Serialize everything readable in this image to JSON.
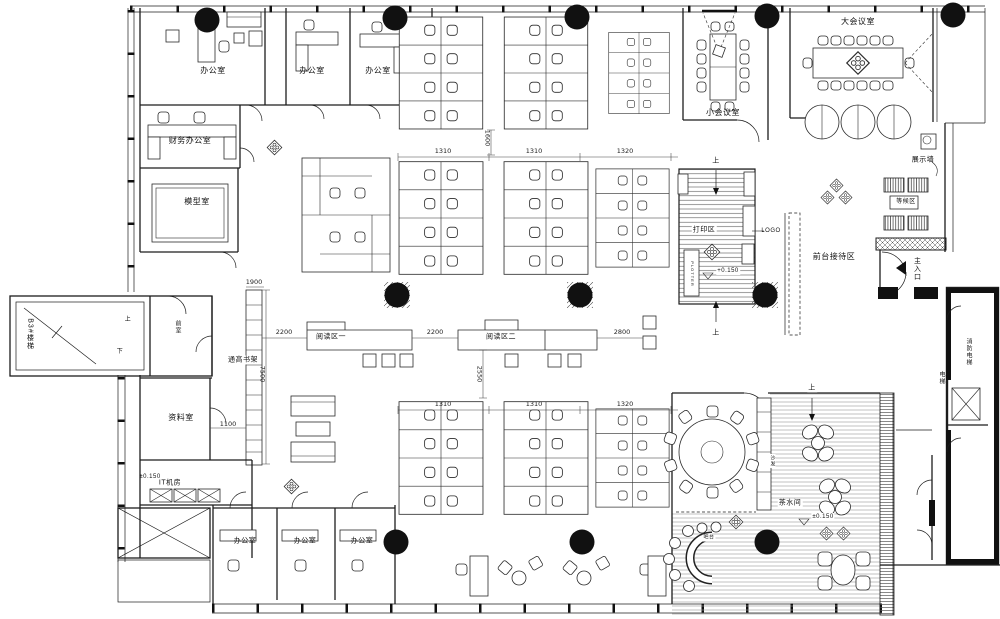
{
  "canvas": {
    "width": 1000,
    "height": 619,
    "background": "#ffffff",
    "ink": "#1c1c1c",
    "column_fill": "#111111"
  },
  "icons": {
    "column": "filled-circle",
    "entrance_arrow": "left-filled-triangle",
    "level_marker": "open-triangle-down",
    "elevator": "crossed-box",
    "decor": "diamond-rosette"
  },
  "texts": [
    {
      "name": "label-office-1",
      "text": "办公室",
      "x": 213,
      "y": 71,
      "fs": 8
    },
    {
      "name": "label-office-2",
      "text": "办公室",
      "x": 312,
      "y": 71,
      "fs": 8
    },
    {
      "name": "label-office-3",
      "text": "办公室",
      "x": 378,
      "y": 71,
      "fs": 8
    },
    {
      "name": "label-finance-office",
      "text": "财务办公室",
      "x": 190,
      "y": 141,
      "fs": 8
    },
    {
      "name": "label-model-room",
      "text": "模型室",
      "x": 197,
      "y": 202,
      "fs": 8
    },
    {
      "name": "label-small-meeting-room",
      "text": "小会议室",
      "x": 723,
      "y": 113,
      "fs": 8
    },
    {
      "name": "label-large-meeting-room",
      "text": "大会议室",
      "x": 858,
      "y": 22,
      "fs": 8
    },
    {
      "name": "label-display-wall",
      "text": "展示墙",
      "x": 923,
      "y": 160,
      "fs": 7
    },
    {
      "name": "label-waiting-area",
      "text": "等候区",
      "x": 906,
      "y": 202,
      "fs": 6,
      "bg": true
    },
    {
      "name": "label-print-area",
      "text": "打印区",
      "x": 704,
      "y": 230,
      "fs": 7,
      "bg": true
    },
    {
      "name": "label-logo",
      "text": "LOGO",
      "x": 771,
      "y": 231,
      "fs": 6
    },
    {
      "name": "label-reception-area",
      "text": "前台接待区",
      "x": 834,
      "y": 257,
      "fs": 8
    },
    {
      "name": "label-reading-area-1",
      "text": "阅读区一",
      "x": 331,
      "y": 337,
      "fs": 7
    },
    {
      "name": "label-reading-area-2",
      "text": "阅读区二",
      "x": 501,
      "y": 337,
      "fs": 7
    },
    {
      "name": "label-tall-bookshelf",
      "text": "通高书架",
      "x": 243,
      "y": 360,
      "fs": 7,
      "bg": true
    },
    {
      "name": "label-b3-stair",
      "text": "B3#楼梯",
      "x": 30,
      "y": 334,
      "fs": 7,
      "v": true
    },
    {
      "name": "label-stair-up",
      "text": "上",
      "x": 128,
      "y": 320,
      "fs": 6
    },
    {
      "name": "label-stair-down",
      "text": "下",
      "x": 120,
      "y": 352,
      "fs": 6
    },
    {
      "name": "label-vestibule",
      "text": "前室",
      "x": 177,
      "y": 327,
      "fs": 6,
      "v": true
    },
    {
      "name": "label-archive-room",
      "text": "资料室",
      "x": 181,
      "y": 418,
      "fs": 8
    },
    {
      "name": "label-it-room",
      "text": "IT机房",
      "x": 170,
      "y": 483,
      "fs": 7
    },
    {
      "name": "label-office-b1",
      "text": "办公室",
      "x": 245,
      "y": 541,
      "fs": 7
    },
    {
      "name": "label-office-b2",
      "text": "办公室",
      "x": 305,
      "y": 541,
      "fs": 7
    },
    {
      "name": "label-office-b3",
      "text": "办公室",
      "x": 362,
      "y": 541,
      "fs": 7
    },
    {
      "name": "label-pantry",
      "text": "茶水间",
      "x": 790,
      "y": 503,
      "fs": 7,
      "bg": true
    },
    {
      "name": "label-sofa",
      "text": "沙发",
      "x": 772,
      "y": 461,
      "fs": 5,
      "v": true,
      "bg": true
    },
    {
      "name": "label-bar",
      "text": "吧台",
      "x": 709,
      "y": 538,
      "fs": 5,
      "bg": true
    },
    {
      "name": "label-main-entrance",
      "text": "主入口",
      "x": 917,
      "y": 269,
      "fs": 7,
      "v": true
    },
    {
      "name": "label-fire-elevator",
      "text": "消防电梯",
      "x": 968,
      "y": 352,
      "fs": 6,
      "v": true
    },
    {
      "name": "label-elevator",
      "text": "电梯",
      "x": 941,
      "y": 378,
      "fs": 6,
      "v": true
    },
    {
      "name": "label-plotter",
      "text": "PLOTTER",
      "x": 692,
      "y": 274,
      "fs": 4,
      "v": true,
      "bg": true
    },
    {
      "name": "label-up-print-top",
      "text": "上",
      "x": 716,
      "y": 161,
      "fs": 7
    },
    {
      "name": "label-up-print-bottom",
      "text": "上",
      "x": 716,
      "y": 333,
      "fs": 7
    },
    {
      "name": "label-up-deck",
      "text": "上",
      "x": 812,
      "y": 388,
      "fs": 7,
      "bg": true
    },
    {
      "name": "level-print",
      "text": "+0.150",
      "x": 728,
      "y": 271,
      "fs": 6,
      "bg": true
    },
    {
      "name": "level-it",
      "text": "±0.150",
      "x": 150,
      "y": 477,
      "fs": 6
    },
    {
      "name": "level-deck",
      "text": "±0.150",
      "x": 823,
      "y": 517,
      "fs": 6,
      "bg": true
    },
    {
      "name": "dim-1600",
      "text": "1600",
      "x": 487,
      "y": 138,
      "fs": 6.5,
      "v": true,
      "dim": true
    },
    {
      "name": "dim-1310-a",
      "text": "1310",
      "x": 443,
      "y": 151,
      "fs": 6.5,
      "dim": true
    },
    {
      "name": "dim-1310-b",
      "text": "1310",
      "x": 534,
      "y": 151,
      "fs": 6.5,
      "dim": true
    },
    {
      "name": "dim-1320-a",
      "text": "1320",
      "x": 625,
      "y": 151,
      "fs": 6.5,
      "dim": true
    },
    {
      "name": "dim-2200-a",
      "text": "2200",
      "x": 284,
      "y": 332,
      "fs": 6.5,
      "dim": true
    },
    {
      "name": "dim-2200-b",
      "text": "2200",
      "x": 435,
      "y": 332,
      "fs": 6.5,
      "dim": true
    },
    {
      "name": "dim-2800",
      "text": "2800",
      "x": 622,
      "y": 332,
      "fs": 6.5,
      "dim": true
    },
    {
      "name": "dim-2550",
      "text": "2550",
      "x": 479,
      "y": 374,
      "fs": 6.5,
      "v": true,
      "dim": true
    },
    {
      "name": "dim-1310-c",
      "text": "1310",
      "x": 443,
      "y": 404,
      "fs": 6.5,
      "dim": true
    },
    {
      "name": "dim-1310-d",
      "text": "1310",
      "x": 534,
      "y": 404,
      "fs": 6.5,
      "dim": true
    },
    {
      "name": "dim-1320-b",
      "text": "1320",
      "x": 625,
      "y": 404,
      "fs": 6.5,
      "dim": true
    },
    {
      "name": "dim-1900",
      "text": "1900",
      "x": 254,
      "y": 282,
      "fs": 6.5,
      "dim": true
    },
    {
      "name": "dim-7500",
      "text": "7500",
      "x": 262,
      "y": 374,
      "fs": 6.5,
      "v": true,
      "dim": true
    },
    {
      "name": "dim-1100",
      "text": "1100",
      "x": 228,
      "y": 424,
      "fs": 6.5,
      "dim": true
    }
  ]
}
